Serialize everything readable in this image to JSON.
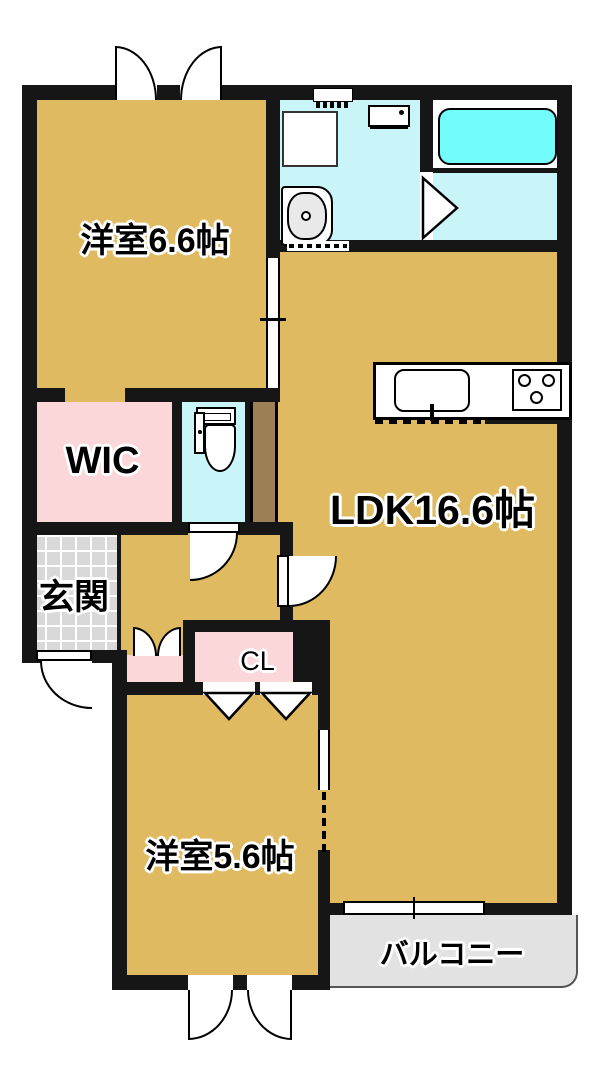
{
  "floorplan": {
    "type": "apartment-floor-plan",
    "rooms": {
      "bedroom1": {
        "label": "洋室6.6帖"
      },
      "ldk": {
        "label": "LDK16.6帖"
      },
      "wic": {
        "label": "WIC"
      },
      "entrance": {
        "label": "玄関"
      },
      "closet": {
        "label": "CL"
      },
      "bedroom2": {
        "label": "洋室5.6帖"
      },
      "balcony": {
        "label": "バルコニー"
      }
    },
    "fixtures": [
      "bathtub",
      "washing-machine-pan",
      "washbasin",
      "toilet",
      "kitchen-counter",
      "kitchen-sink",
      "gas-stove",
      "vent",
      "water-heater-panel"
    ],
    "colors": {
      "tan": "#dfba60",
      "pink": "#fbd7d9",
      "cyan": "#c9f5f9",
      "tub": "#72fcfc",
      "tile": "#d9d9d9",
      "balc": "#e2e2e2",
      "brown": "#9d7f56",
      "wall": "#161616"
    }
  }
}
